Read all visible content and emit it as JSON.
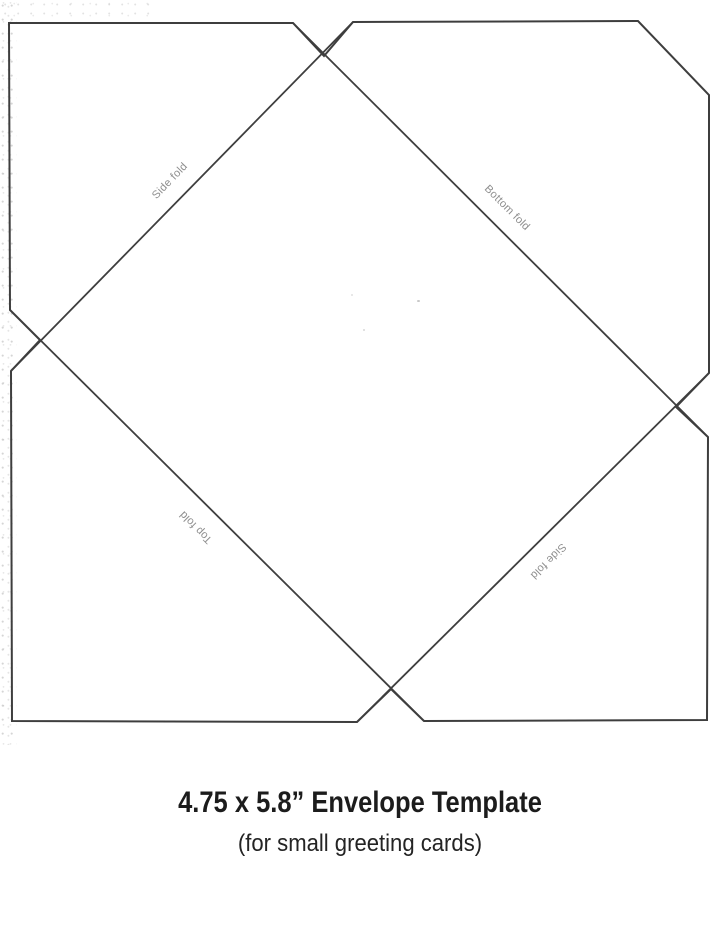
{
  "diagram": {
    "fold_labels": {
      "side_top_left": "Side fold",
      "bottom": "Bottom fold",
      "top": "Top fold",
      "side_bottom_right": "Side fold"
    },
    "line_color": "#3e3e3e",
    "label_color": "#8e8e8e"
  },
  "caption": {
    "title": "4.75 x 5.8” Envelope Template",
    "subtitle": "(for small greeting cards)"
  },
  "page": {
    "background": "#ffffff"
  }
}
